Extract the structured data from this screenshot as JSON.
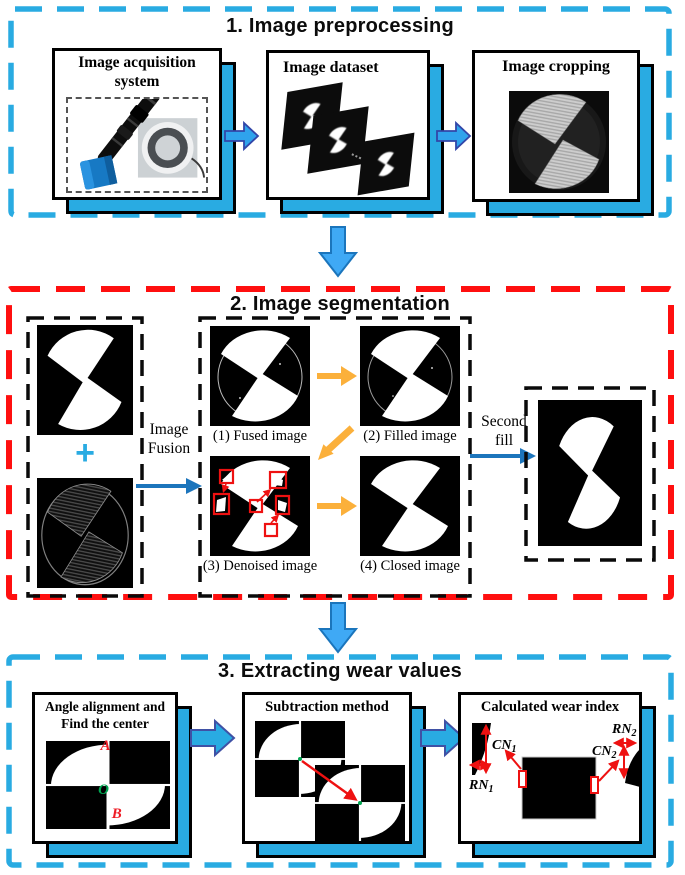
{
  "page": {
    "background": "#ffffff"
  },
  "colors": {
    "section_border_cyan": "#29ABE2",
    "section_border_red": "#FF0F0F",
    "card_shadow_cyan": "#29ABE2",
    "flow_arrow_blue": "#29ABE2",
    "flow_arrow_light_blue": "#3FA9F5",
    "line_arrow_blue": "#1C75BC",
    "step_arrow_yellow": "#FBB03B",
    "annotation_red": "#EE1111",
    "annotation_green": "#00A651",
    "image_black": "#000000"
  },
  "icons": {
    "flow_arrow_right": "block-right-arrow",
    "flow_arrow_down": "block-down-arrow",
    "line_arrow_right": "thin-right-arrow",
    "yellow_step_arrow": "thick-right-arrow",
    "plus_icon": "+",
    "measure_arrow": "double-headed-arrow"
  },
  "sections": {
    "preprocessing": {
      "title": "1. Image preprocessing",
      "cards": {
        "acquisition": {
          "title_line1": "Image acquisition",
          "title_line2": "system"
        },
        "dataset": {
          "title": "Image dataset"
        },
        "cropping": {
          "title": "Image cropping"
        }
      }
    },
    "segmentation": {
      "title": "2. Image segmentation",
      "plus_sign": "+",
      "fusion_label": {
        "line1": "Image",
        "line2": "Fusion"
      },
      "second_fill_label": {
        "line1": "Second",
        "line2": "fill"
      },
      "steps": {
        "fused": "(1) Fused image",
        "filled": "(2) Filled image",
        "denoised": "(3) Denoised image",
        "closed": "(4) Closed image"
      }
    },
    "extracting": {
      "title": "3. Extracting wear values",
      "cards": {
        "alignment": {
          "title_line1": "Angle alignment and",
          "title_line2": "Find the center",
          "point_a": "A",
          "point_o": "O",
          "point_b": "B"
        },
        "subtraction": {
          "title": "Subtraction method"
        },
        "wear_index": {
          "title": "Calculated wear index",
          "cn1": {
            "base": "CN",
            "sub": "1"
          },
          "rn1": {
            "base": "RN",
            "sub": "1"
          },
          "cn2": {
            "base": "CN",
            "sub": "2"
          },
          "rn2": {
            "base": "RN",
            "sub": "2"
          }
        }
      }
    }
  }
}
